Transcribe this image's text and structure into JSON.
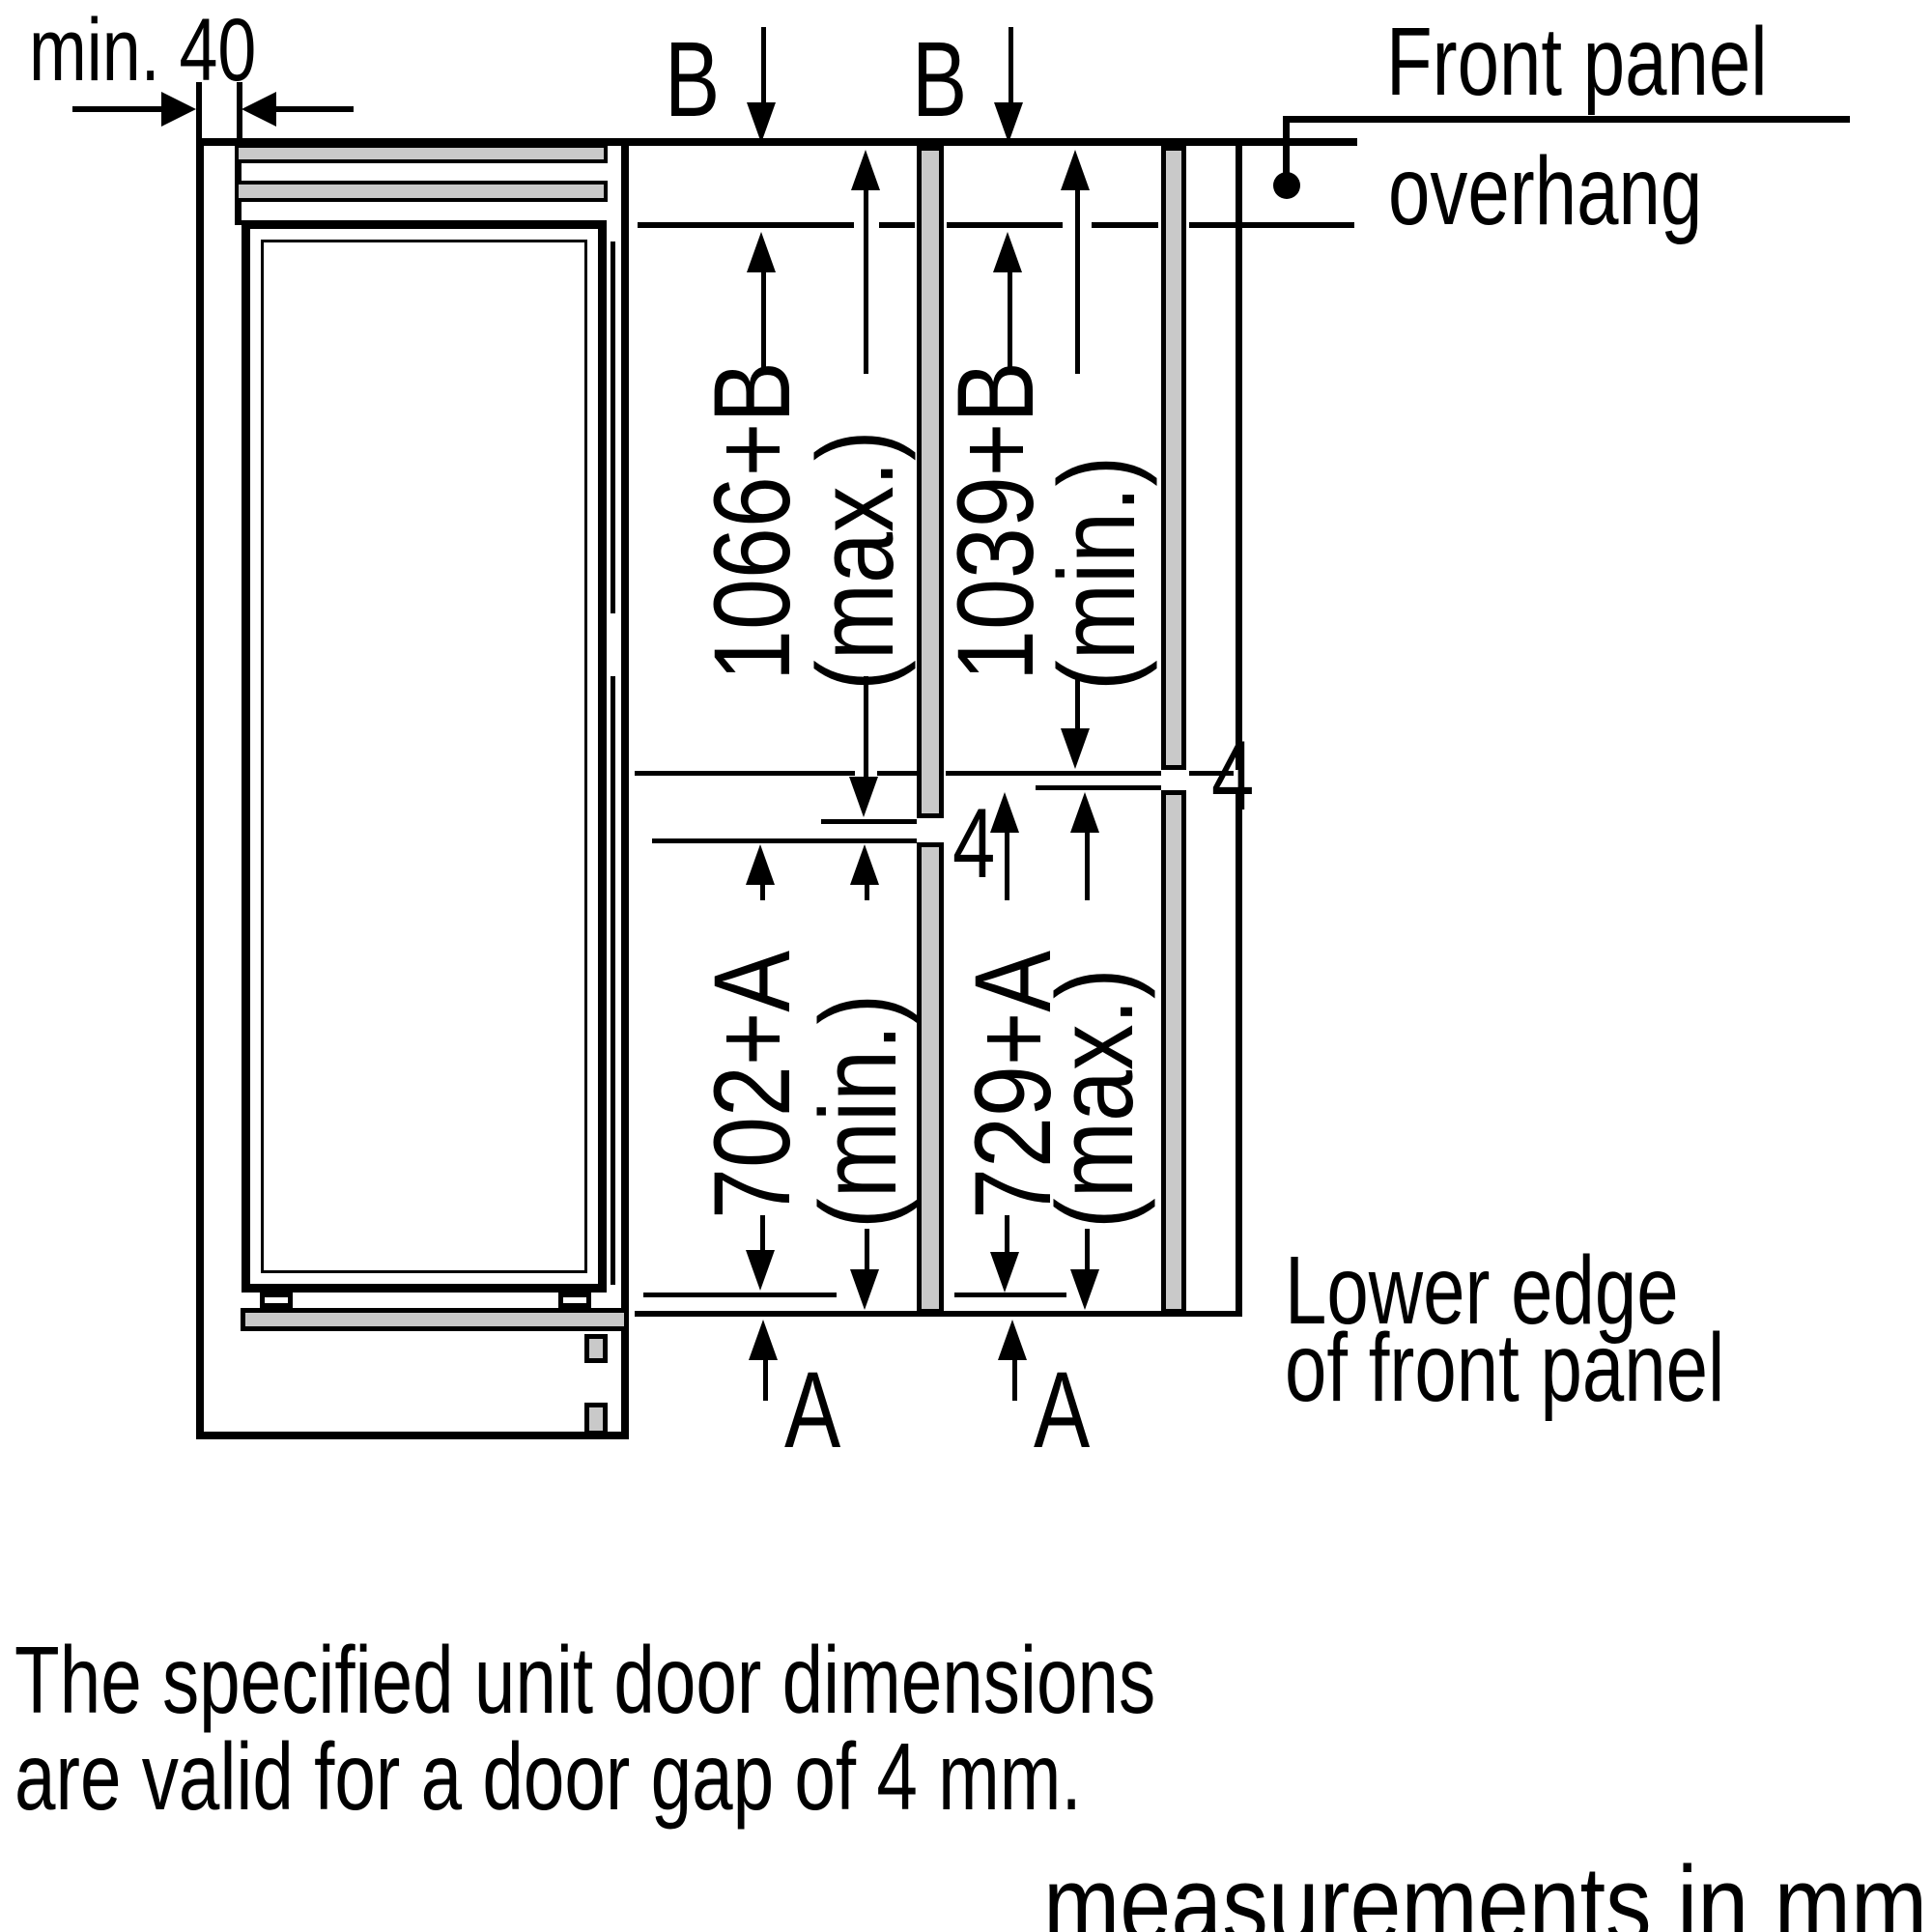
{
  "note": {
    "line1": "The specified unit door dimensions",
    "line2": "are valid for a door gap of 4 mm."
  },
  "footer": {
    "units_note": "measurements in mm"
  },
  "diagram": {
    "top_gap_label": "min. 40",
    "b_label_left": "B",
    "b_label_right": "B",
    "front_panel_caption": {
      "line1": "Front panel",
      "line2": "overhang"
    },
    "lower_edge_caption": {
      "line1": "Lower edge",
      "line2": "of front panel"
    },
    "door_gap_left": "4",
    "door_gap_right": "4",
    "a_label_left": "A",
    "a_label_right": "A",
    "dims": {
      "upper_left": {
        "value": "1066+B",
        "qualifier": "(max.)"
      },
      "upper_right": {
        "value": "1039+B",
        "qualifier": "(min.)"
      },
      "lower_left": {
        "value": "702+A",
        "qualifier": "(min.)"
      },
      "lower_right": {
        "value": "729+A",
        "qualifier": "(max.)"
      }
    }
  },
  "colors": {
    "line": "#000000",
    "panel_gray": "#c9c9c9",
    "background": "#ffffff"
  }
}
